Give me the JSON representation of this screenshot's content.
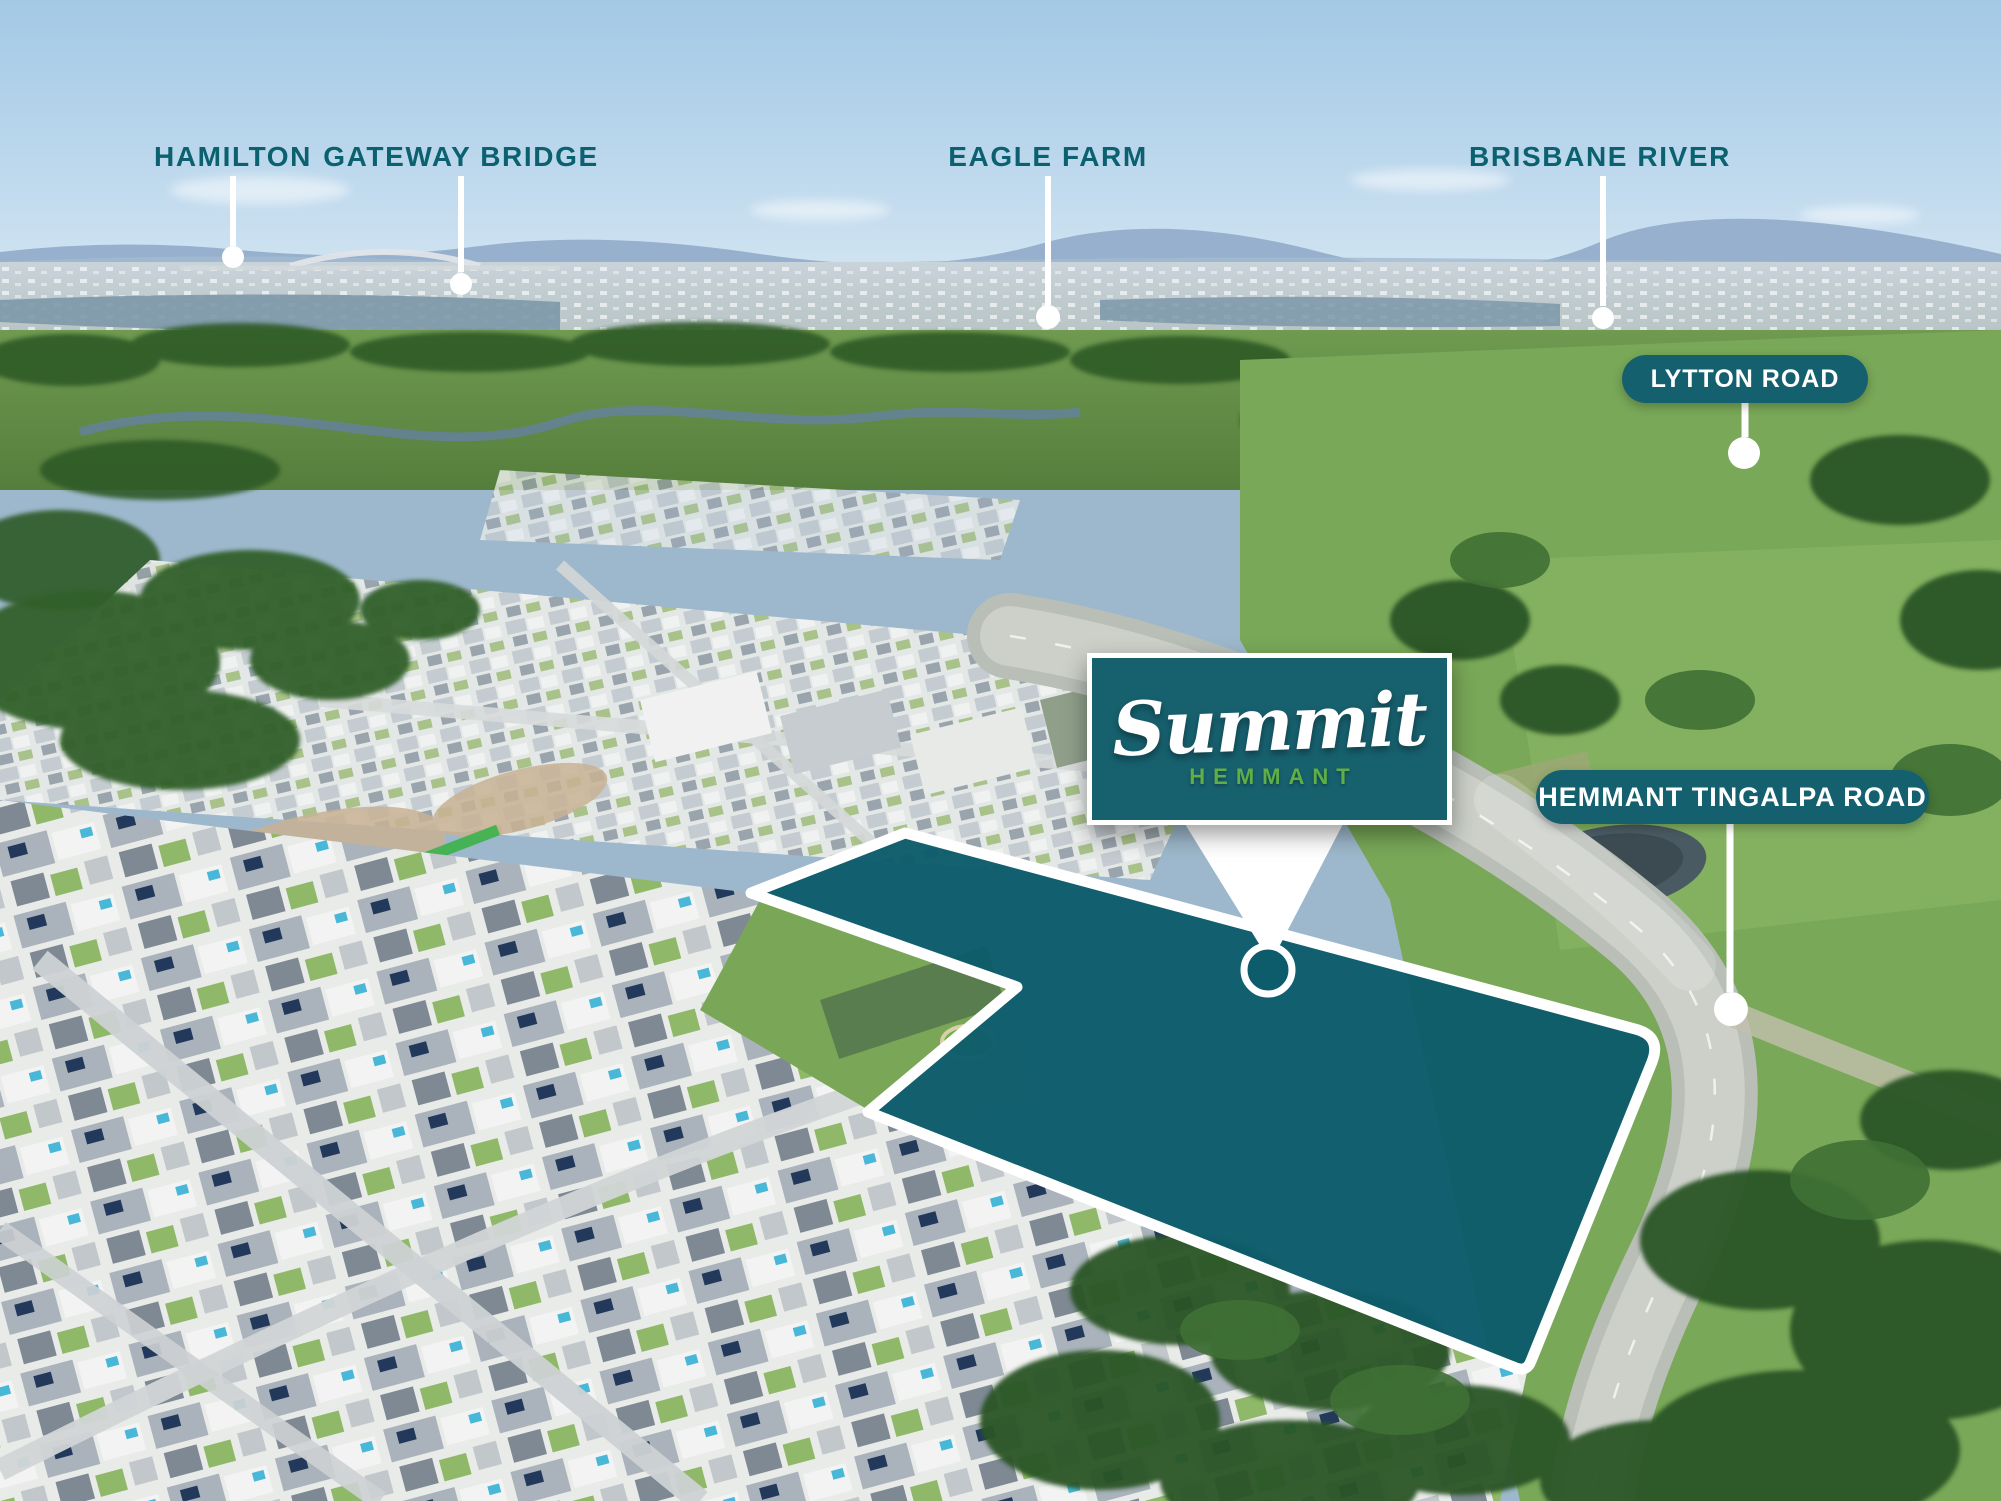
{
  "scene": {
    "description": "Aerial drone photograph of a suburban land development site with marketing annotations"
  },
  "landmarks": [
    {
      "id": "hamilton",
      "text": "HAMILTON"
    },
    {
      "id": "gateway-bridge",
      "text": "GATEWAY BRIDGE"
    },
    {
      "id": "eagle-farm",
      "text": "EAGLE FARM"
    },
    {
      "id": "brisbane-river",
      "text": "BRISBANE RIVER"
    }
  ],
  "badges": [
    {
      "id": "lytton-road",
      "text": "LYTTON ROAD"
    },
    {
      "id": "hemmant-tingalpa-road",
      "text": "HEMMANT TINGALPA ROAD"
    }
  ],
  "logo": {
    "name": "Summit",
    "subtitle": "HEMMANT"
  },
  "colors": {
    "label_teal": "#0c6170",
    "badge_teal": "#14606f",
    "logo_teal": "#17606e",
    "parcel_teal": "#0d5c6b",
    "hemmant_green": "#5fae46",
    "pin_white": "#ffffff"
  }
}
